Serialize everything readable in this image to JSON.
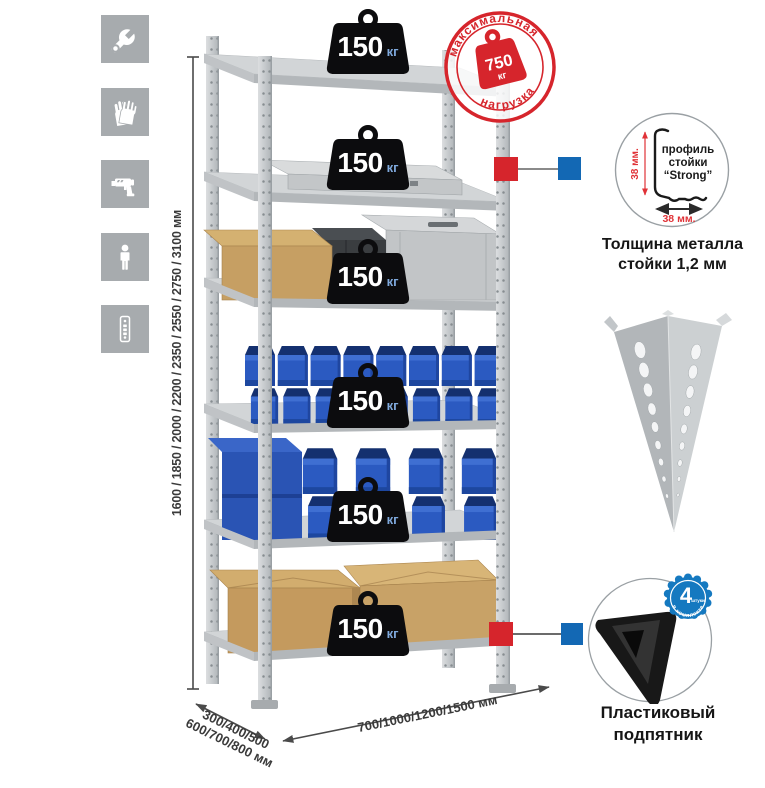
{
  "colors": {
    "accent_red": "#d6252c",
    "callout_blue": "#1368b4",
    "bin_blue": "#2b5ac1",
    "metal_gray": "#c6c9cb",
    "icon_tile_gray": "#a7abae",
    "weight_black": "#0c0c0e",
    "weight_unit_blue": "#7fa9dc"
  },
  "left_icons": [
    {
      "name": "wrench"
    },
    {
      "name": "gloves"
    },
    {
      "name": "drill"
    },
    {
      "name": "person"
    },
    {
      "name": "perforated-post"
    }
  ],
  "dimensions": {
    "height_values": "1600 / 1850 / 2000 / 2200 / 2350 / 2550 / 2750 / 3100 мм",
    "depth_values_line1": "300/400/500",
    "depth_values_line2": "600/700/800 мм",
    "width_values": "700/1000/1200/1500 мм"
  },
  "shelf_load_labels": [
    {
      "value": "150",
      "unit": "кг"
    },
    {
      "value": "150",
      "unit": "кг"
    },
    {
      "value": "150",
      "unit": "кг"
    },
    {
      "value": "150",
      "unit": "кг"
    },
    {
      "value": "150",
      "unit": "кг"
    },
    {
      "value": "150",
      "unit": "кг"
    }
  ],
  "max_load_stamp": {
    "arc_text_top": "максимальная",
    "arc_text_bottom": "нагрузка",
    "value": "750",
    "unit": "кг"
  },
  "profile_detail": {
    "label_line1": "профиль",
    "label_line2": "стойки",
    "label_line3": "“Strong”",
    "dim_vertical": "38 мм.",
    "dim_horizontal": "38 мм.",
    "caption_line1": "Толщина металла",
    "caption_line2": "стойки 1,2 мм"
  },
  "foot_detail": {
    "badge_value": "4",
    "badge_unit": "штуки",
    "badge_arc_text": "в комплекте",
    "caption_line1": "Пластиковый",
    "caption_line2": "подпятник"
  }
}
